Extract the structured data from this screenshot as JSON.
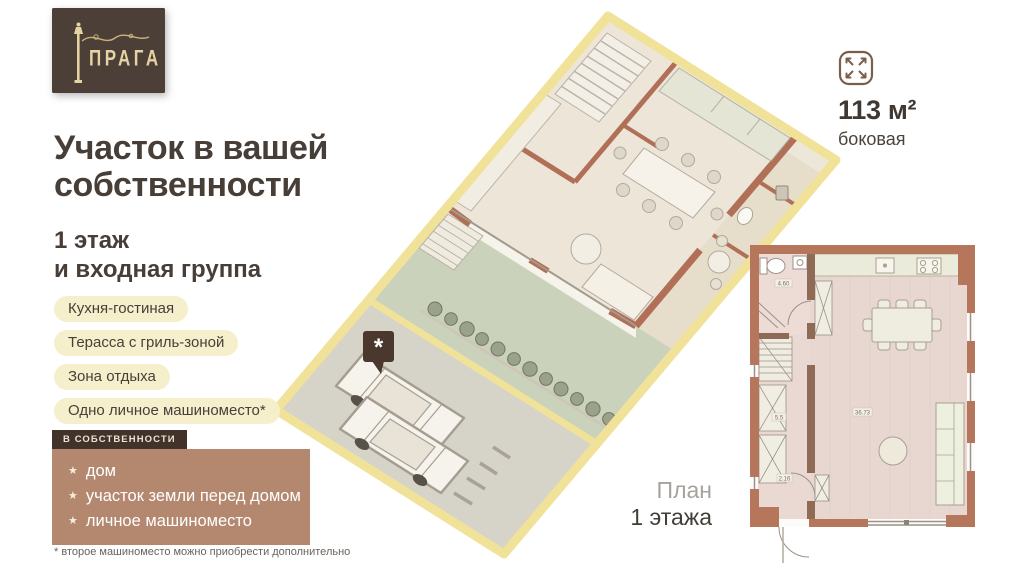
{
  "logo": {
    "brand": "ПРАГА"
  },
  "headline": {
    "line1": "Участок в вашей",
    "line2": "собственности"
  },
  "subtitle": {
    "line1": "1 этаж",
    "line2": "и входная группа"
  },
  "features": [
    "Кухня-гостиная",
    "Терасса с гриль-зоной",
    "Зона отдыха",
    "Одно личное машиноместо*"
  ],
  "ownership": {
    "tab": "в собственности",
    "bullet": "★",
    "items": [
      "дом",
      "участок земли перед домом",
      "личное машиноместо"
    ]
  },
  "footnote": "* второе машиноместо можно приобрести дополнительно",
  "area_badge": {
    "value": "113 м²",
    "label": "боковая"
  },
  "plan_caption": {
    "line1": "План",
    "line2": "1 этажа"
  },
  "map_pin": {
    "symbol": "*"
  },
  "floor_plan": {
    "room_labels": {
      "bathroom": "4.60",
      "hall": "5.5",
      "entry": "2.16",
      "living": "36.73"
    }
  },
  "colors": {
    "brand_box": "#4b3f38",
    "brand_gold": "#e6d3a4",
    "title_text": "#483e38",
    "pill_bg": "#f6efcc",
    "ownership_tab": "#41332a",
    "ownership_box": "#b4886f",
    "plot_outline": "#f1e29a",
    "wall_terracotta": "#b06f56",
    "lawn_green": "#cbd2bb",
    "parking_gray": "#d6d3c8",
    "floor_pink": "#e7d7d0"
  }
}
